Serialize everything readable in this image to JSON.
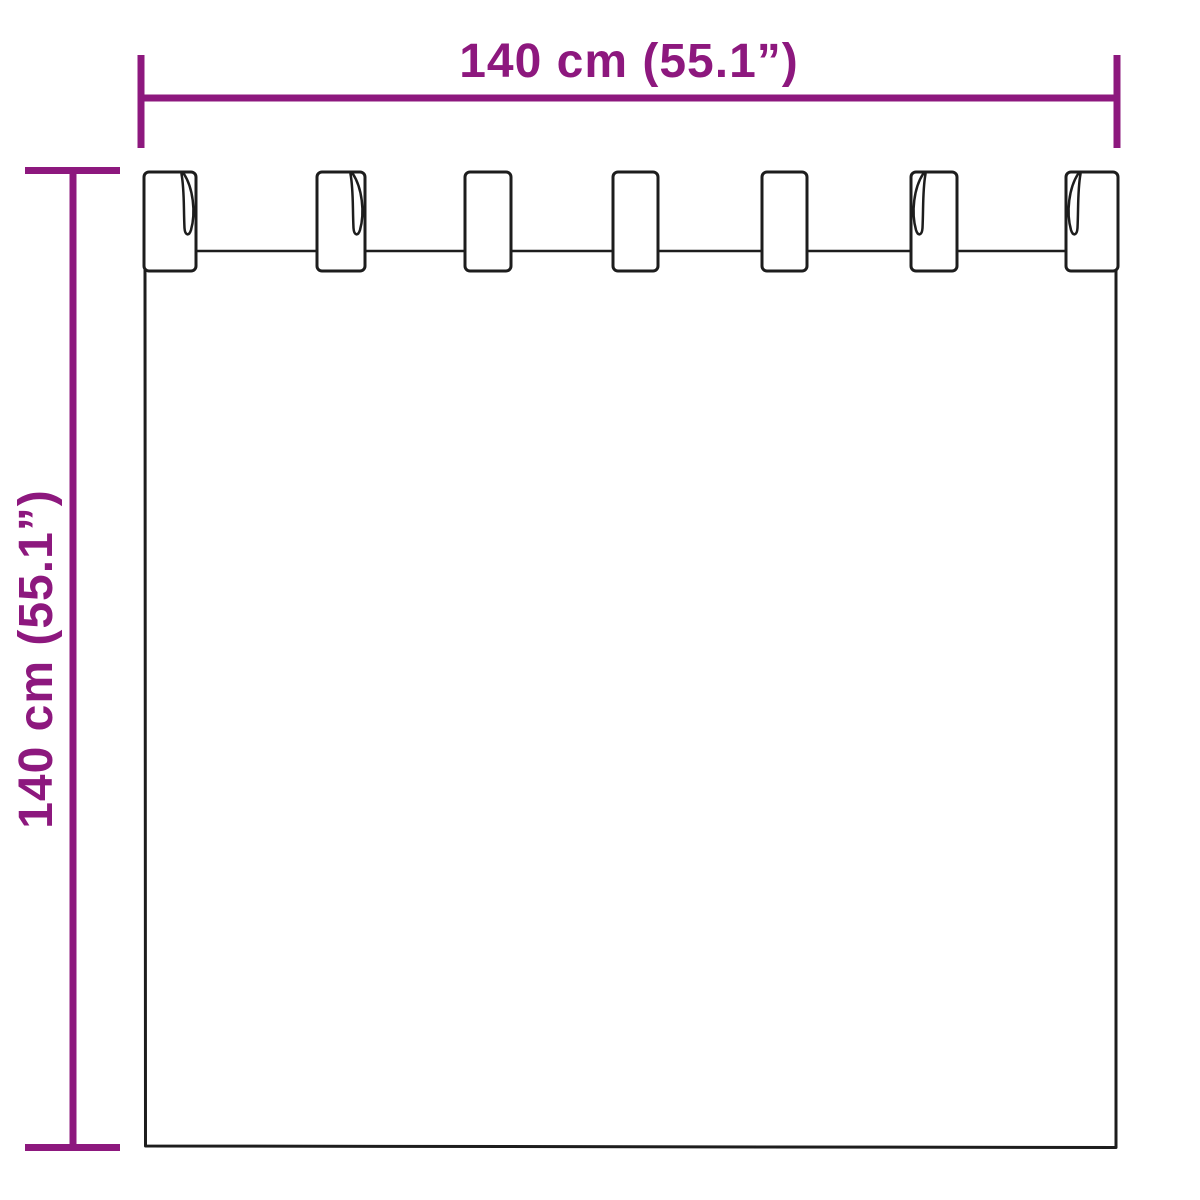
{
  "diagram": {
    "type": "product-dimension-diagram",
    "drawing_subject": "tab-top-curtain-outline",
    "background_color": "#ffffff",
    "dimension_color": "#8d187e",
    "drawing_color": "#1d1d1d",
    "width_dimension": {
      "label": "140 cm (55.1”)"
    },
    "height_dimension": {
      "label": "140 cm (55.1”)"
    },
    "tab_count": 7
  }
}
